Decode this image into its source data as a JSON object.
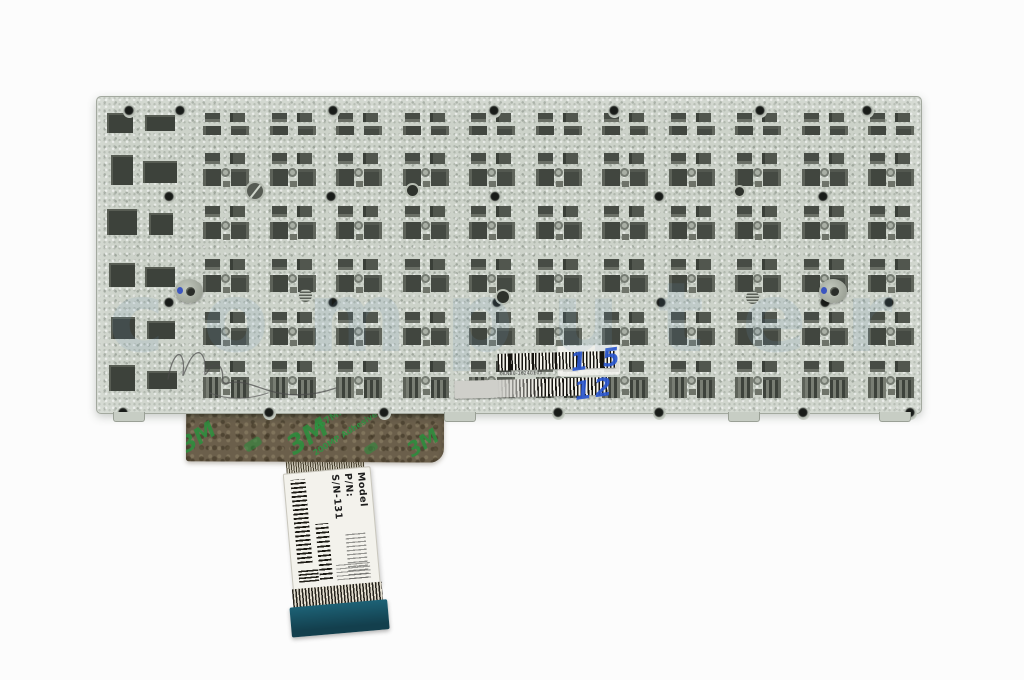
{
  "colors": {
    "background": "#fcfcfc",
    "plate": "#ccd2c9",
    "cutout_dark": "#42473f",
    "tape_brown": "#6b5f4b",
    "tape_print_green": "#2c8e3e",
    "stiffener_teal": "#1d6276",
    "handwriting_blue": "#2b57cf",
    "watermark_blue": "#6f9cc4"
  },
  "watermark": {
    "text": "computer"
  },
  "plate_sticker": {
    "part_number": "0KNB0-3624GE00",
    "handwriting": "1 5 12"
  },
  "tape": {
    "brand_logo": "3M",
    "spec_line1": "467MP",
    "spec_line2": "200MP Adhesive"
  },
  "cable_label": {
    "model": "Model",
    "pn": "P/N:",
    "sn": "S/N-131"
  }
}
